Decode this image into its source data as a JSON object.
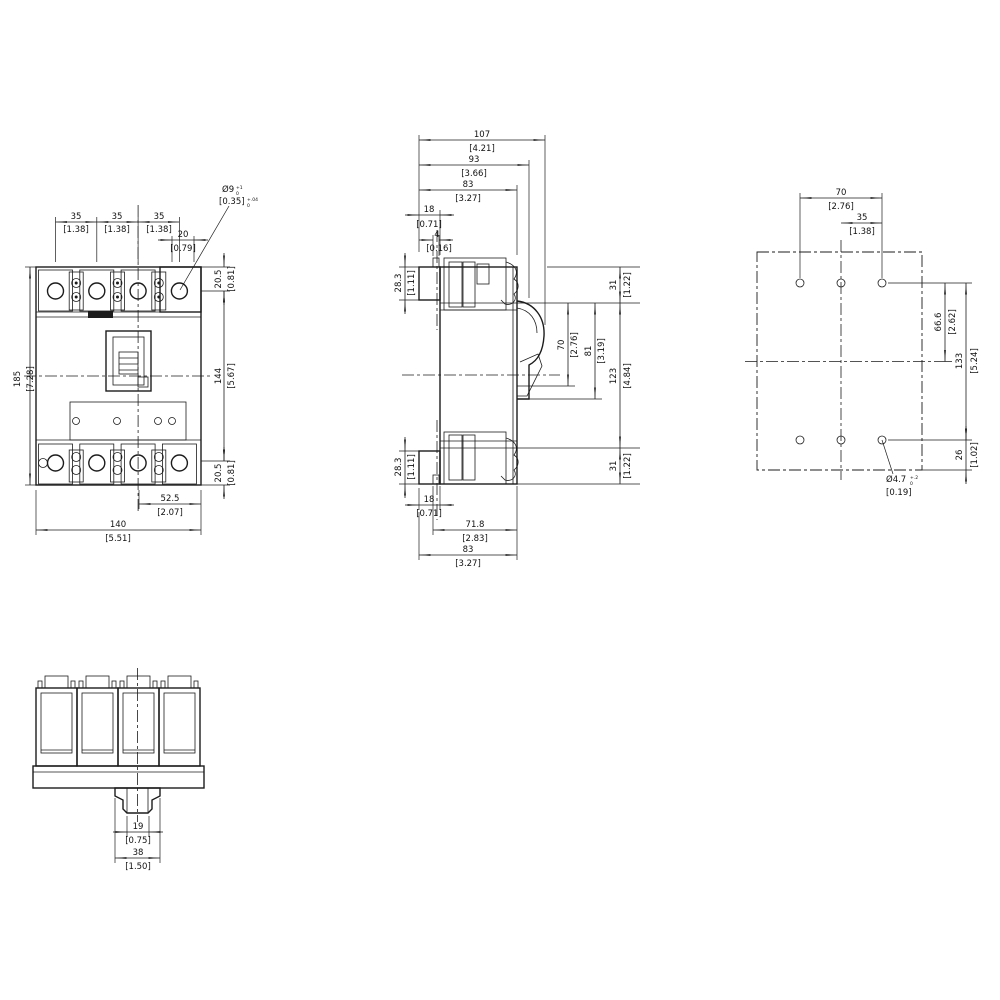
{
  "dims": {
    "front": {
      "p1": {
        "mm": "35",
        "in": "[1.38]"
      },
      "p2": {
        "mm": "35",
        "in": "[1.38]"
      },
      "p3": {
        "mm": "35",
        "in": "[1.38]"
      },
      "off20": {
        "mm": "20",
        "in": "[0.79]"
      },
      "hole": {
        "mm": "Ø9",
        "in": "[0.35]",
        "mm_tol_plus": "+1",
        "mm_tol_minus": "0",
        "in_tol_plus": "+.04",
        "in_tol_minus": "0"
      },
      "h185": {
        "mm": "185",
        "in": "[7.28]"
      },
      "m205t": {
        "mm": "20.5",
        "in": "[0.81]"
      },
      "h144": {
        "mm": "144",
        "in": "[5.67]"
      },
      "m205b": {
        "mm": "20.5",
        "in": "[0.81]"
      },
      "w525": {
        "mm": "52.5",
        "in": "[2.07]"
      },
      "w140": {
        "mm": "140",
        "in": "[5.51]"
      }
    },
    "side": {
      "d107": {
        "mm": "107",
        "in": "[4.21]"
      },
      "d93": {
        "mm": "93",
        "in": "[3.66]"
      },
      "d83t": {
        "mm": "83",
        "in": "[3.27]"
      },
      "s18t": {
        "mm": "18",
        "in": "[0.71]"
      },
      "s4": {
        "mm": "4",
        "in": "[0.16]"
      },
      "t283t": {
        "mm": "28.3",
        "in": "[1.11]"
      },
      "t283b": {
        "mm": "28.3",
        "in": "[1.11]"
      },
      "s31t": {
        "mm": "31",
        "in": "[1.22]"
      },
      "w70": {
        "mm": "70",
        "in": "[2.76]"
      },
      "w81": {
        "mm": "81",
        "in": "[3.19]"
      },
      "m123": {
        "mm": "123",
        "in": "[4.84]"
      },
      "s31b": {
        "mm": "31",
        "in": "[1.22]"
      },
      "s18b": {
        "mm": "18",
        "in": "[0.71]"
      },
      "d718": {
        "mm": "71.8",
        "in": "[2.83]"
      },
      "d83b": {
        "mm": "83",
        "in": "[3.27]"
      }
    },
    "rear": {
      "p70": {
        "mm": "70",
        "in": "[2.76]"
      },
      "p35": {
        "mm": "35",
        "in": "[1.38]"
      },
      "c666": {
        "mm": "66.6",
        "in": "[2.62]"
      },
      "r133": {
        "mm": "133",
        "in": "[5.24]"
      },
      "e26": {
        "mm": "26",
        "in": "[1.02]"
      },
      "hole": {
        "mm": "Ø4.7",
        "in": "[0.19]",
        "mm_tol_plus": "+.2",
        "mm_tol_minus": "0"
      }
    },
    "bottom": {
      "s19": {
        "mm": "19",
        "in": "[0.75]"
      },
      "s38": {
        "mm": "38",
        "in": "[1.50]"
      }
    }
  }
}
